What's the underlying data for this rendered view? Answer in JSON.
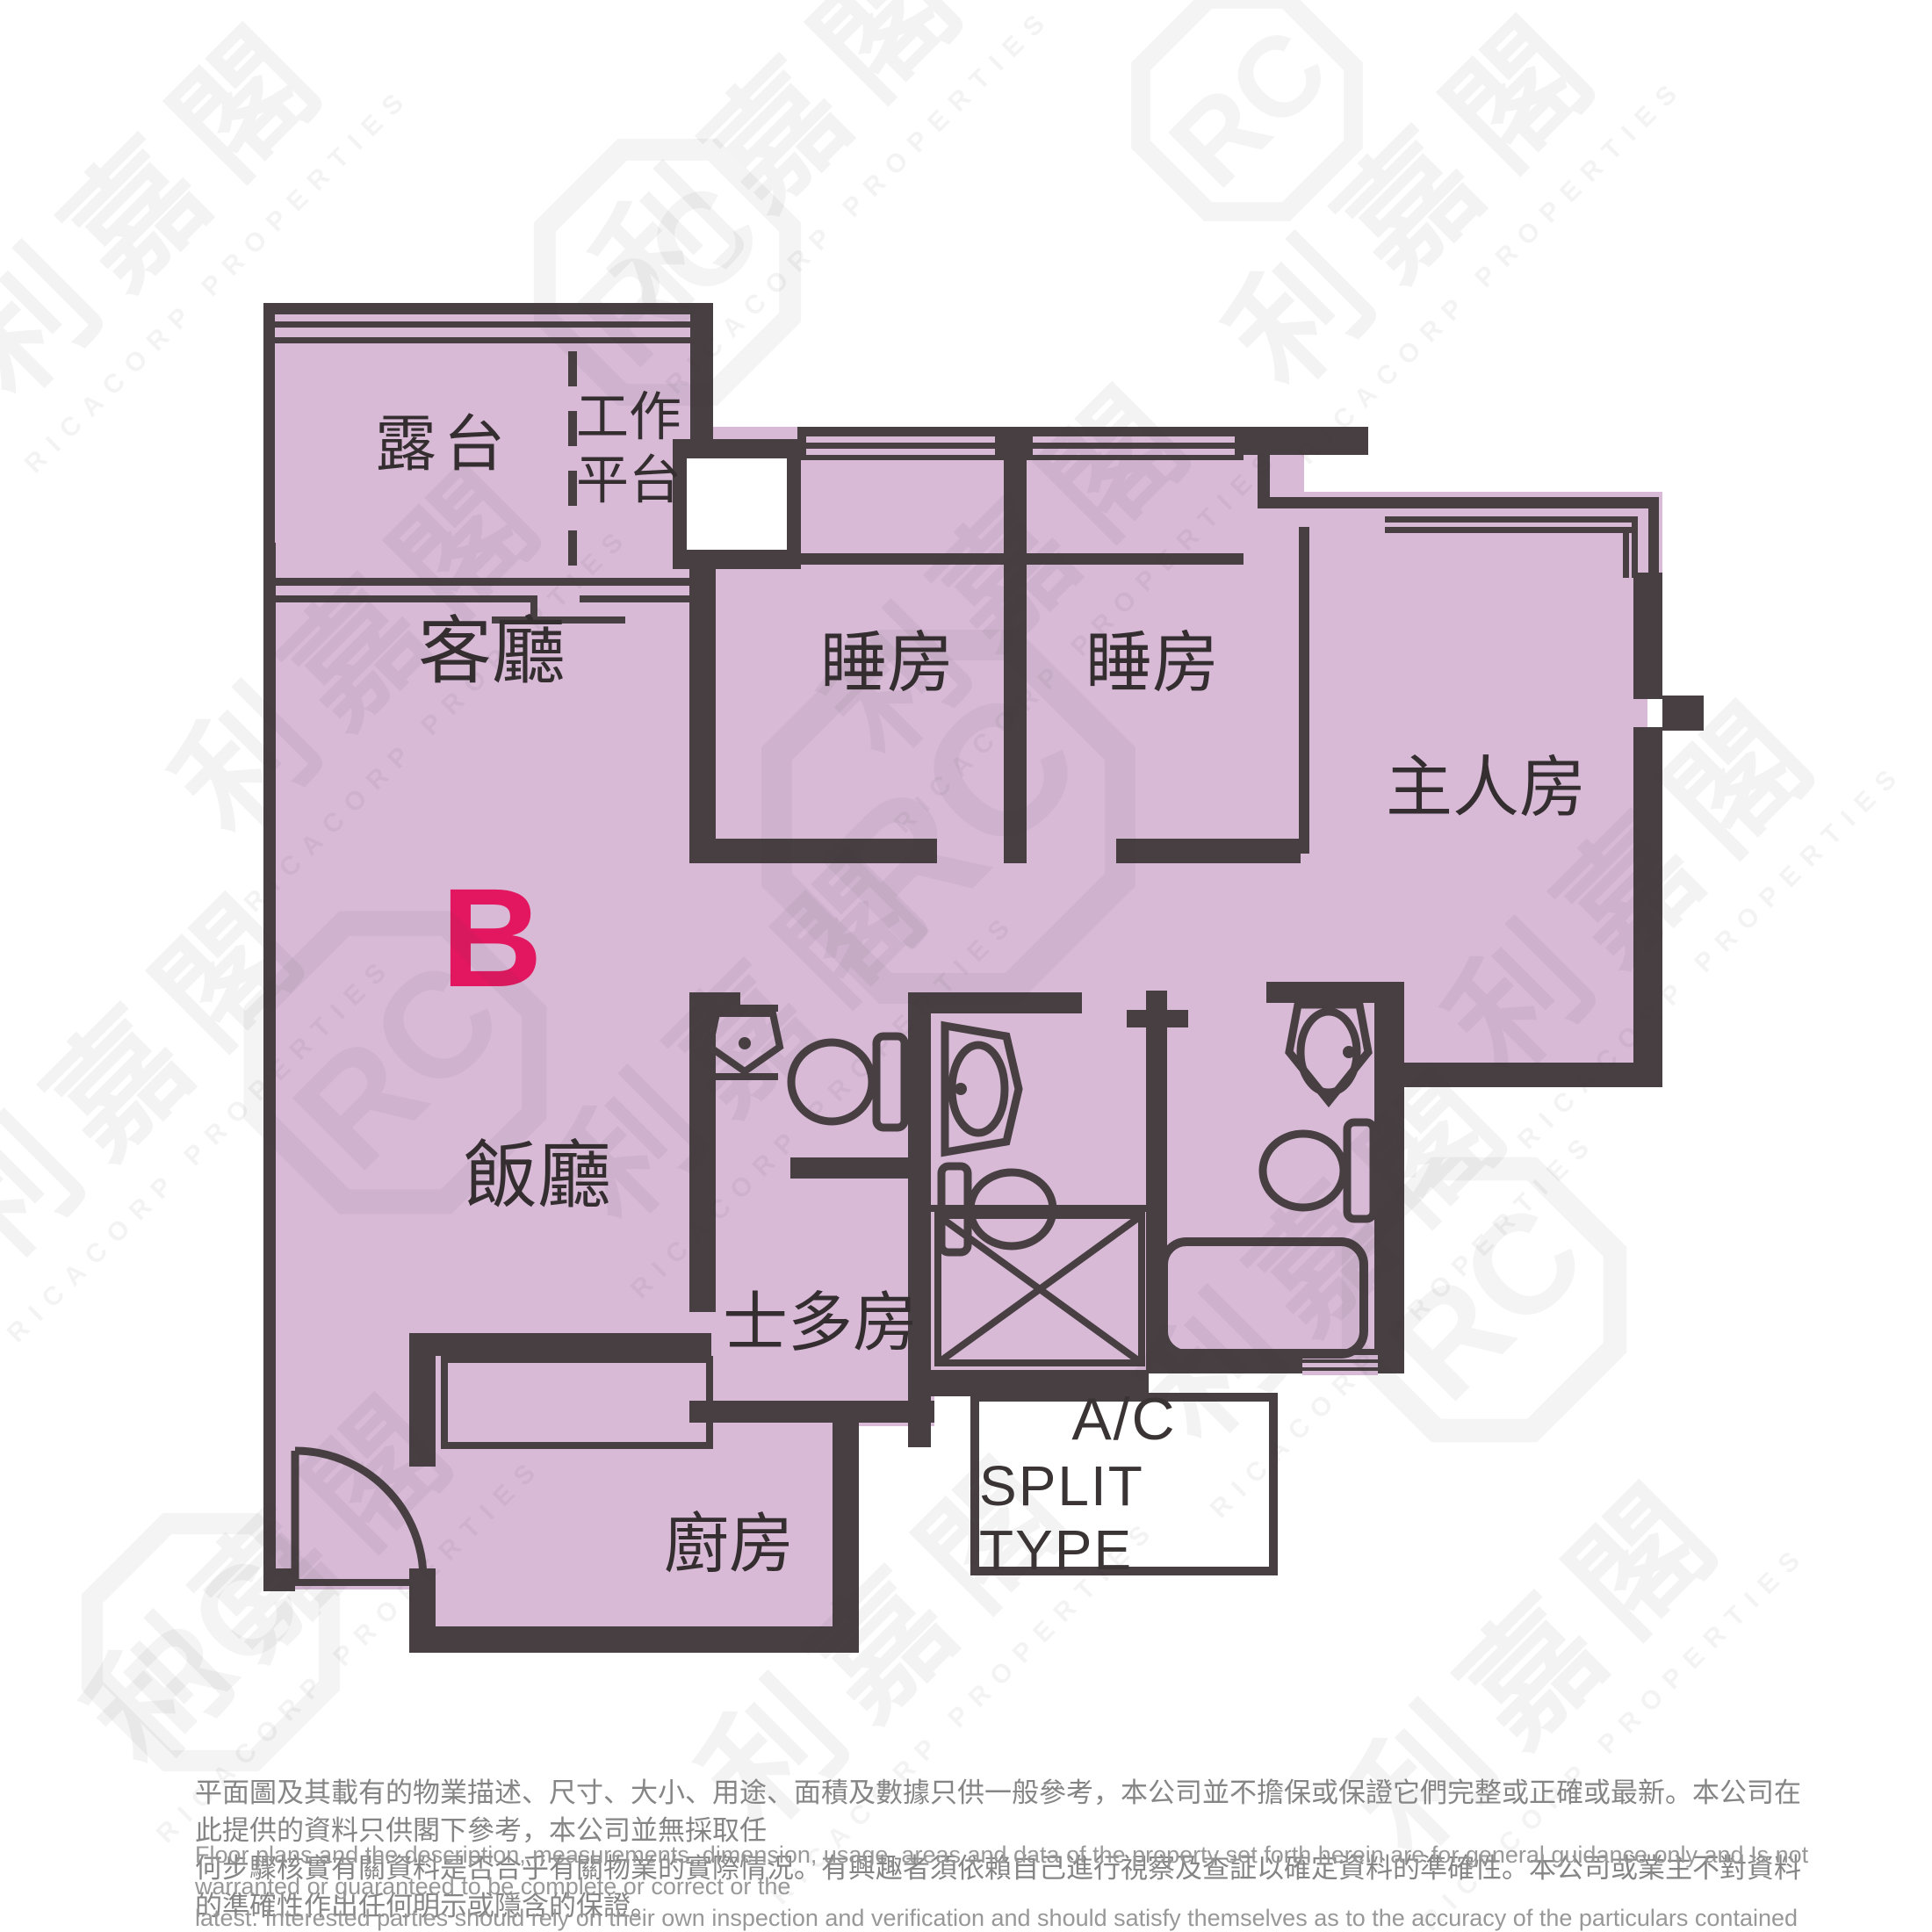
{
  "floor_plan": {
    "unit_label": "B",
    "rooms": {
      "balcony": "露台",
      "utility_platform": [
        "工作",
        "平台"
      ],
      "living_room": "客廳",
      "dining_room": "飯廳",
      "bedroom_1": "睡房",
      "bedroom_2": "睡房",
      "master_bedroom": "主人房",
      "store_room": "士多房",
      "kitchen": "廚房"
    },
    "ac_label": [
      "A/C",
      "SPLIT TYPE"
    ]
  },
  "watermark": {
    "chinese": "利嘉閣",
    "english": "RICACORP PROPERTIES",
    "monogram": "RC"
  },
  "colors": {
    "room_fill": "#d8bad7",
    "wall": "#473f41",
    "unit_accent": "#e3175f",
    "label_text": "#352e30",
    "disclaimer_zh": "#858585",
    "disclaimer_en": "#989898"
  },
  "disclaimer": {
    "chinese_lines": [
      "平面圖及其載有的物業描述、尺寸、大小、用途、面積及數據只供一般參考，本公司並不擔保或保證它們完整或正確或最新。本公司在此提供的資料只供閣下參考，本公司並無採取任",
      "何步驟核實有關資料是否合乎有關物業的實際情況。有興趣者須依賴自己進行視察及查証以確定資料的準確性。本公司或業主不對資料的準確性作出任何明示或隱含的保證。"
    ],
    "english_lines": [
      "Floor plans and the description, measurements, dimension, usage, areas and data of the property set forth herein are for general guidance only and Is not warranted or guaranteed to be complete or correct or the",
      "latest. Interested parties should rely on their own inspection and verification and should satisfy themselves as to the accuracy of the particulars contained herein which are provided by us for information only.  Our",
      "Company has not taken any step to verify whether the information reflects the actual status of the property.  No warranty for accuracy is given or implied by the owners or us."
    ]
  }
}
